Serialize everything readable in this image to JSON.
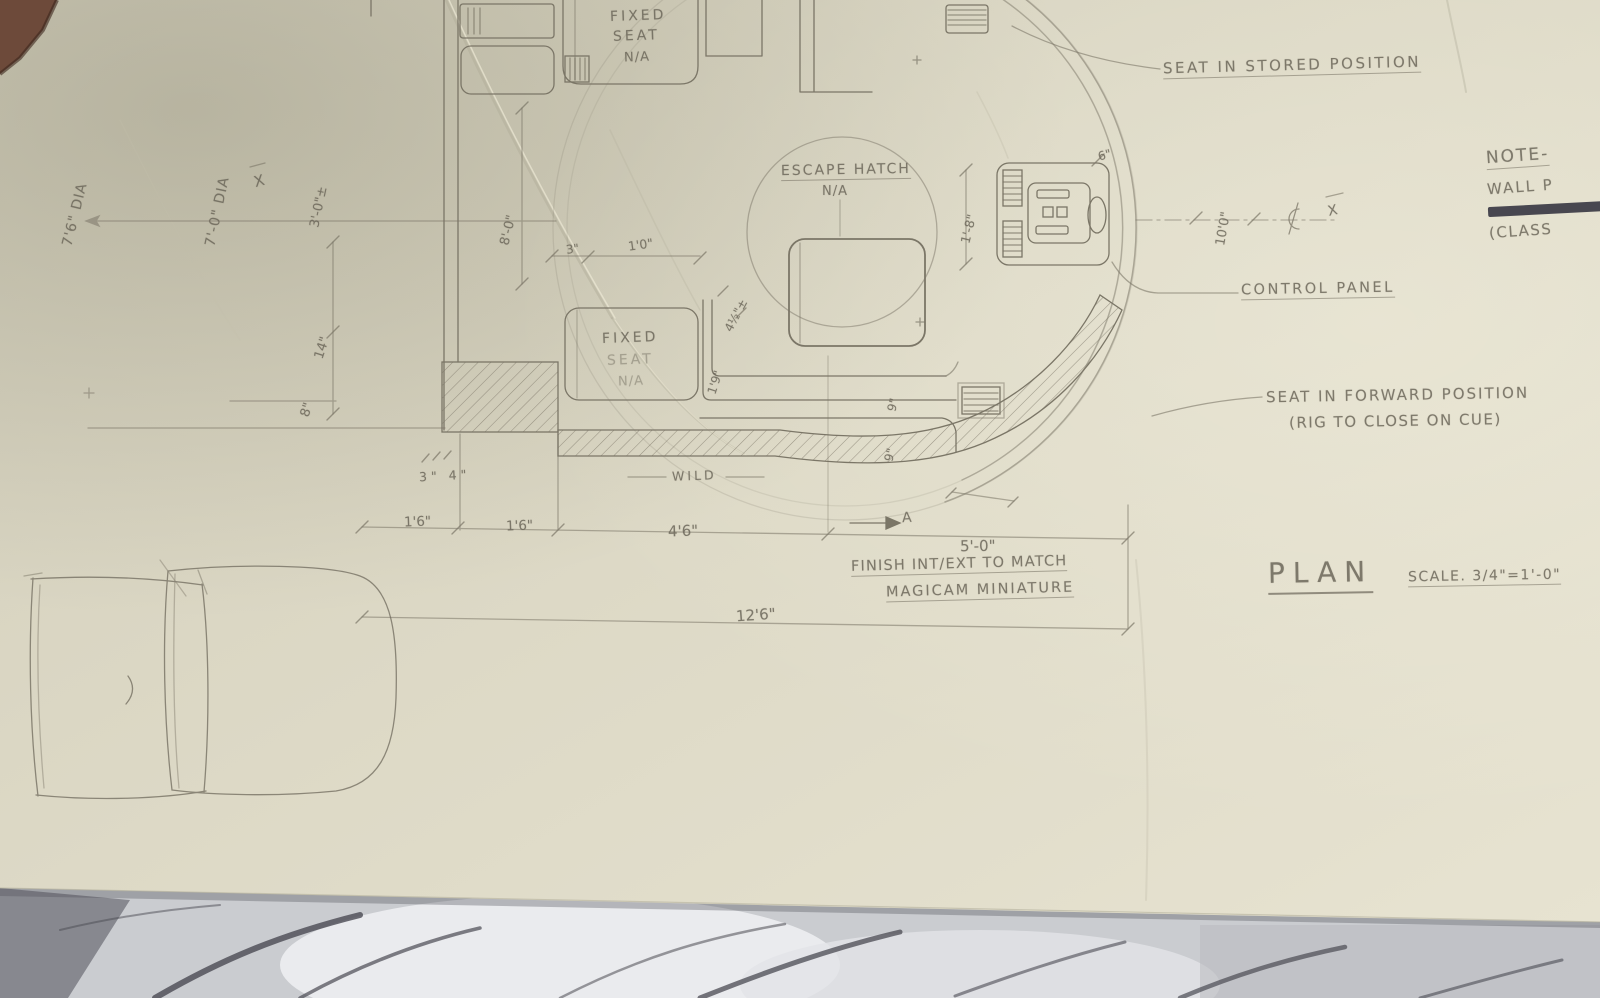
{
  "colors": {
    "paper": "#dcd8c5",
    "pencil": "#6c675a",
    "ink_bar": "#3b3a44",
    "marble_base": "#caccd0",
    "marble_vein": "#4a4a52",
    "table_corner": "#87888f",
    "clip_corner": "#6d4a3a"
  },
  "annotations": {
    "seat_stored": "SEAT IN STORED POSITION",
    "control_panel": "CONTROL PANEL",
    "seat_forward": {
      "line1": "SEAT IN FORWARD POSITION",
      "line2": "(RIG TO CLOSE ON CUE)"
    },
    "note": {
      "title": "NOTE-",
      "line1": "WALL P",
      "line2": "(CLASS"
    },
    "escape_hatch": {
      "label": "ESCAPE HATCH",
      "na": "N/A"
    },
    "fixed_seat_top": {
      "l1": "FIXED",
      "l2": "SEAT",
      "l3": "N/A"
    },
    "fixed_seat_mid": {
      "l1": "FIXED",
      "l2": "SEAT",
      "l3": "N/A"
    },
    "wild": "WILD",
    "finish": {
      "line1": "FINISH INT/EXT TO MATCH",
      "line2": "MAGICAM MINIATURE"
    },
    "plan": {
      "title": "PLAN",
      "scale": "SCALE. 3/4\"=1'-0\""
    },
    "section_marker": "A",
    "centerline_x": "X",
    "axis_x": "X"
  },
  "dimensions": {
    "dia_outer": "7'6\" DIA",
    "dia_inner": "7'-0\" DIA",
    "offset_3ft": "3'-0\"±",
    "w14": "14\"",
    "w8": "8\"",
    "h8ft": "8'-0\"",
    "w3": "3\"",
    "w1ft": "1'0\"",
    "w4h": "4½\"±",
    "d19_left": "1'9\"",
    "d9_upper": "9\"",
    "d9_lower": "9\"",
    "d18": "1'-8\"",
    "d10ft": "10'0\"",
    "d6": "6\"",
    "d34": "3\" 4\"",
    "d16_a": "1'6\"",
    "d16_b": "1'6\"",
    "d46": "4'6\"",
    "d50": "5'-0\"",
    "d126": "12'6\""
  },
  "icons": {
    "centerline_symbol": "centerline",
    "section_arrow": "arrow-right",
    "north_overline": "overline"
  }
}
